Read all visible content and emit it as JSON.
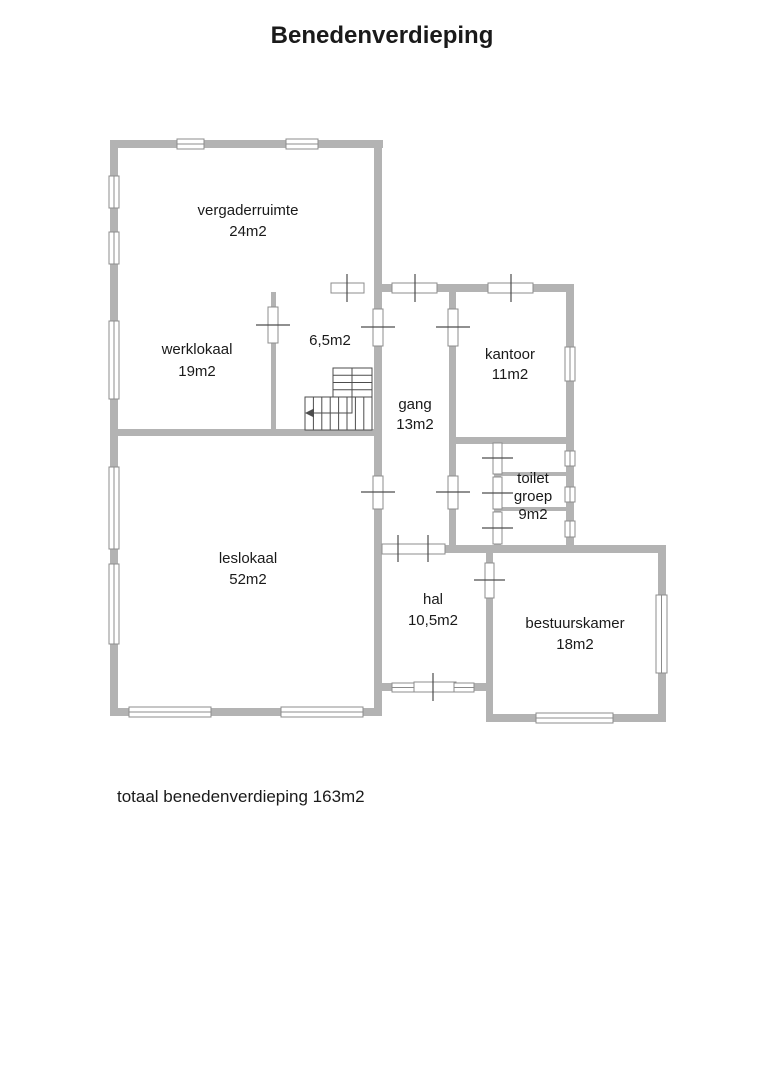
{
  "title": "Benedenverdieping",
  "footer": {
    "total": "totaal benedenverdieping 163m2"
  },
  "rooms": {
    "vergaderruimte": {
      "name": "vergaderruimte",
      "area": "24m2"
    },
    "werklokaal": {
      "name": "werklokaal",
      "area": "19m2"
    },
    "trapkamer": {
      "area": "6,5m2"
    },
    "gang": {
      "name": "gang",
      "area": "13m2"
    },
    "kantoor": {
      "name": "kantoor",
      "area": "11m2"
    },
    "toiletgroep": {
      "name_line1": "toilet",
      "name_line2": "groep",
      "area": "9m2"
    },
    "leslokaal": {
      "name": "leslokaal",
      "area": "52m2"
    },
    "hal": {
      "name": "hal",
      "area": "10,5m2"
    },
    "bestuurskamer": {
      "name": "bestuurskamer",
      "area": "18m2"
    }
  },
  "colors": {
    "wall": "#b3b3b3",
    "opening_outline": "#8c8c8c",
    "tick": "#4d4d4d",
    "text": "#1a1a1a"
  }
}
